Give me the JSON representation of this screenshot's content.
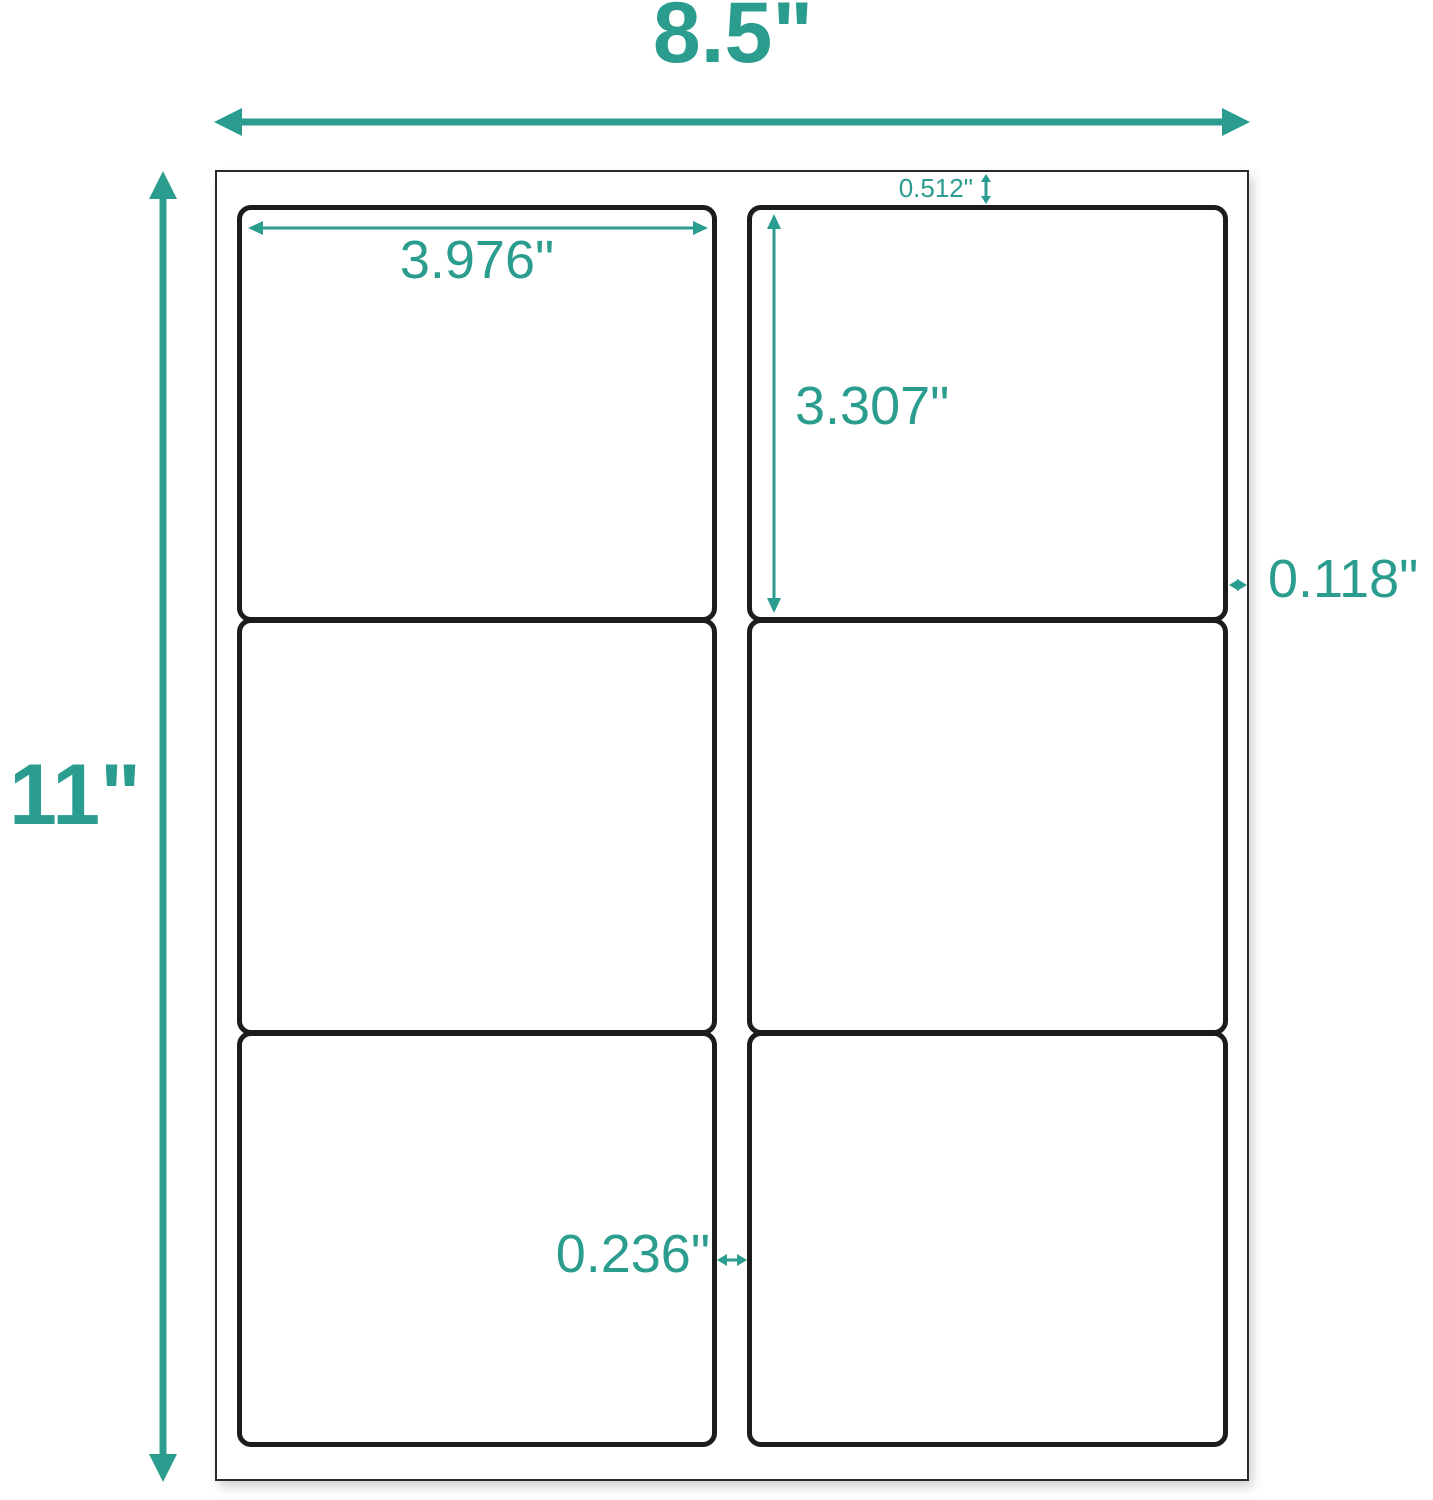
{
  "colors": {
    "accent": "#2a9d8f",
    "label_border": "#1c1c1c",
    "sheet_border": "#2a2a2a"
  },
  "dimensions": {
    "sheet_width": "8.5\"",
    "sheet_height": "11\"",
    "label_width": "3.976\"",
    "label_height": "3.307\"",
    "top_margin": "0.512\"",
    "side_margin": "0.118\"",
    "column_gap": "0.236\""
  }
}
